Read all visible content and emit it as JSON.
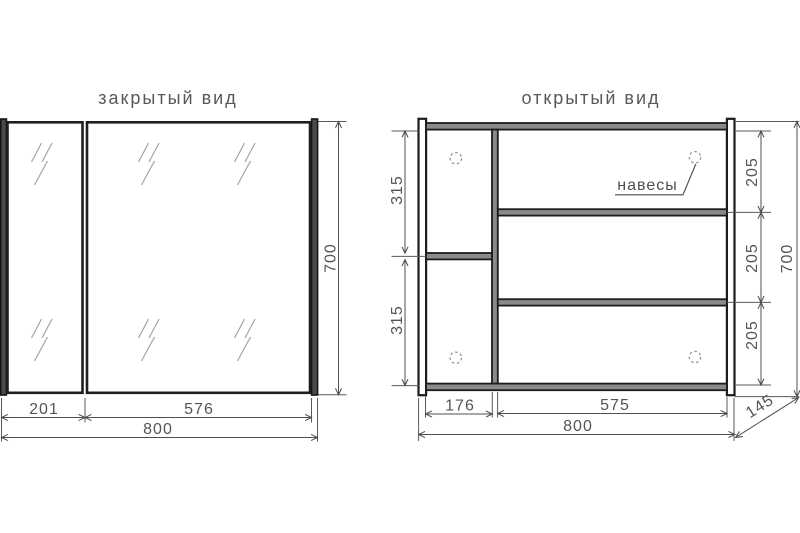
{
  "colors": {
    "ink": "#1f1f1f",
    "dim_line": "#4f4f4f",
    "label_text": "#565656",
    "bar_fill": "#8a8a8a",
    "background": "#ffffff"
  },
  "closed_view": {
    "title": "закрытый вид",
    "dim_door_left": "201",
    "dim_door_right": "576",
    "dim_width": "800",
    "dim_height": "700"
  },
  "open_view": {
    "title": "открытый вид",
    "hangers_label": "навесы",
    "dim_left_top": "315",
    "dim_left_bottom": "315",
    "dim_section_top": "205",
    "dim_section_mid": "205",
    "dim_section_bottom": "205",
    "dim_height": "700",
    "dim_col_left": "176",
    "dim_col_right": "575",
    "dim_width": "800",
    "dim_depth": "145"
  }
}
